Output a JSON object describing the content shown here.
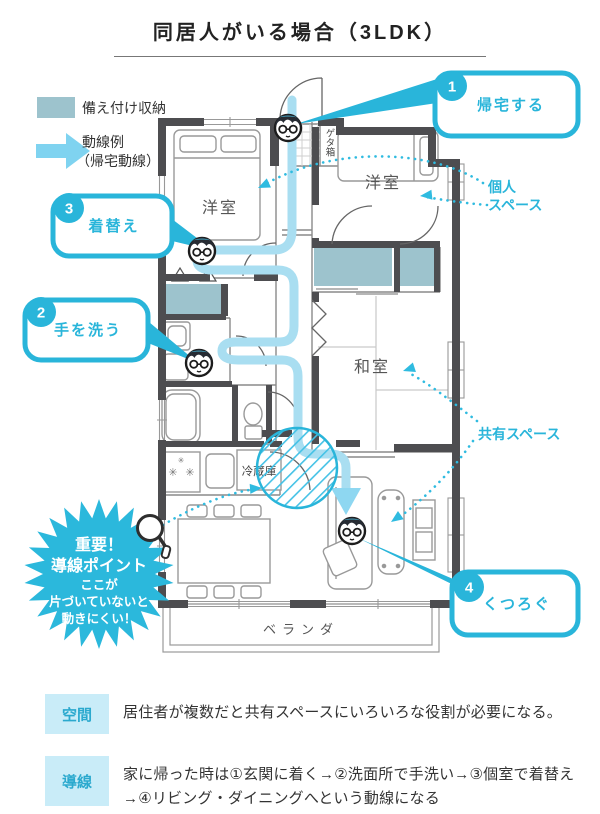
{
  "title": "同居人がいる場合（3LDK）",
  "legend": {
    "storage_label": "備え付け収納",
    "flow_label_1": "動線例",
    "flow_label_2": "（帰宅動線）"
  },
  "callout1": {
    "num": "1",
    "label": "帰宅する"
  },
  "callout2": {
    "num": "2",
    "label": "手を洗う"
  },
  "callout3": {
    "num": "3",
    "label": "着替え"
  },
  "callout4": {
    "num": "4",
    "label": "くつろぐ"
  },
  "rooms": {
    "bedroom_left": "洋室",
    "bedroom_right": "洋室",
    "japanese_room": "和室",
    "veranda": "ベランダ",
    "fridge": "冷蔵庫",
    "shoe_box": "ゲタ箱"
  },
  "labels": {
    "personal_space_1": "個人",
    "personal_space_2": "スペース",
    "shared_space": "共有スペース"
  },
  "starburst": {
    "line1": "重要！",
    "line2": "導線ポイント",
    "line3": "ここが",
    "line4": "片づいていないと",
    "line5": "動きにくい！"
  },
  "notes": {
    "space_tag": "空間",
    "space_text": "居住者が複数だと共有スペースにいろいろな役割が必要になる。",
    "flow_tag": "導線",
    "flow_text": "家に帰った時は①玄関に着く→②洗面所で手洗い→③個室で着替え→④リビング・ダイニングへという動線になる"
  },
  "colors": {
    "accent": "#29b5da",
    "flow": "#a9def1",
    "storage": "#9dc3cd",
    "wall": "#4d4d50"
  }
}
